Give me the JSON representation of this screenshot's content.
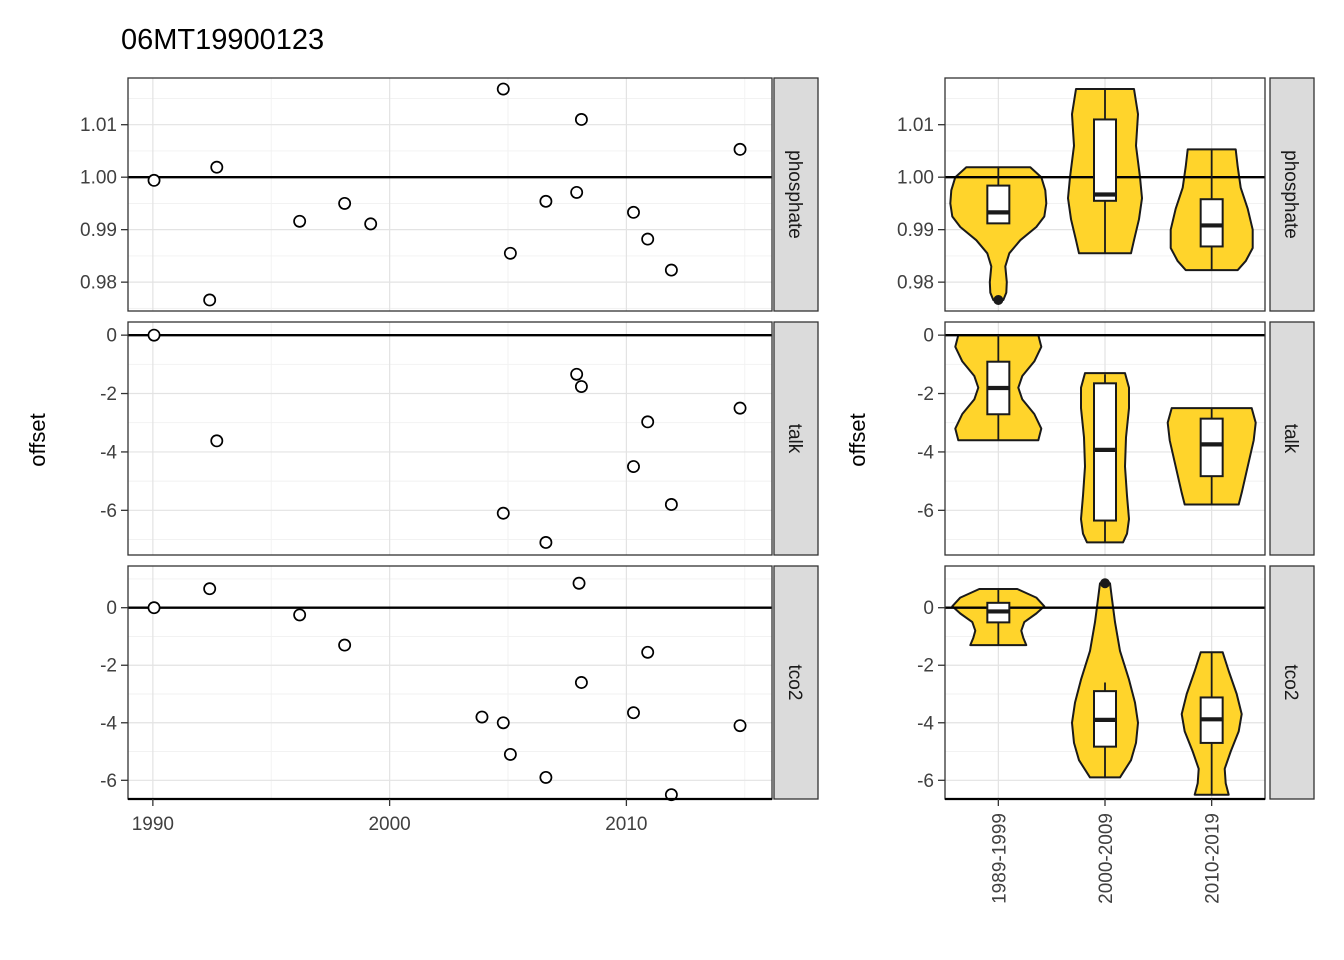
{
  "title": "06MT19900123",
  "ylabel": "offset",
  "colors": {
    "violin_fill": "#FFD42B",
    "outline": "#1A1A1A",
    "panel_border": "#333333",
    "strip_bg": "#DBDBDB",
    "grid_major": "#E3E3E3",
    "grid_minor": "#F1F1F1",
    "axis_text": "#404040",
    "ref_line": "#000000",
    "point_fill": "#FFFFFF"
  },
  "chart_data": {
    "type": [
      "scatter",
      "violin"
    ],
    "title": "06MT19900123",
    "ylabel": "offset",
    "left_plot": {
      "xlabel_ticks": [
        "1990",
        "2000",
        "2010"
      ],
      "xtick_values": [
        1990,
        2000,
        2010
      ],
      "xtick_minor": [
        1995,
        2005,
        2015
      ],
      "xlim": [
        1988.95,
        2016.15
      ],
      "panels": [
        {
          "facet": "phosphate",
          "ref_line": 1.0,
          "ylim": [
            0.9745,
            1.0189
          ],
          "ytick_values": [
            0.98,
            0.99,
            1.0,
            1.01
          ],
          "ytick_labels": [
            "0.98",
            "0.99",
            "1.00",
            "1.01"
          ],
          "ytick_minor": [
            0.975,
            0.985,
            0.995,
            1.005,
            1.015
          ],
          "points": [
            [
              1990.05,
              0.9994
            ],
            [
              1992.4,
              0.9766
            ],
            [
              1992.7,
              1.0019
            ],
            [
              1996.2,
              0.9916
            ],
            [
              1998.1,
              0.995
            ],
            [
              1999.2,
              0.9911
            ],
            [
              2004.8,
              1.0168
            ],
            [
              2005.1,
              0.9855
            ],
            [
              2006.6,
              0.9954
            ],
            [
              2007.9,
              0.9971
            ],
            [
              2008.1,
              1.011
            ],
            [
              2010.3,
              0.9933
            ],
            [
              2010.9,
              0.9882
            ],
            [
              2011.9,
              0.9823
            ],
            [
              2014.8,
              1.0053
            ]
          ]
        },
        {
          "facet": "talk",
          "ref_line": 0,
          "ylim": [
            -7.53,
            0.45
          ],
          "ytick_values": [
            0,
            -2,
            -4,
            -6
          ],
          "ytick_labels": [
            "0",
            "-2",
            "-4",
            "-6"
          ],
          "ytick_minor": [
            -1,
            -3,
            -5,
            -7
          ],
          "points": [
            [
              1990.05,
              0.0
            ],
            [
              1992.7,
              -3.62
            ],
            [
              2004.8,
              -6.1
            ],
            [
              2006.6,
              -7.1
            ],
            [
              2007.9,
              -1.34
            ],
            [
              2008.1,
              -1.76
            ],
            [
              2010.3,
              -4.5
            ],
            [
              2010.9,
              -2.97
            ],
            [
              2011.9,
              -5.8
            ],
            [
              2014.8,
              -2.5
            ]
          ]
        },
        {
          "facet": "tco2",
          "ref_line": 0,
          "ylim": [
            -6.65,
            1.45
          ],
          "ytick_values": [
            0,
            -2,
            -4,
            -6
          ],
          "ytick_labels": [
            "0",
            "-2",
            "-4",
            "-6"
          ],
          "ytick_minor": [
            1,
            -1,
            -3,
            -5
          ],
          "points": [
            [
              1990.05,
              0.0
            ],
            [
              1992.4,
              0.66
            ],
            [
              1996.2,
              -0.25
            ],
            [
              1998.1,
              -1.3
            ],
            [
              2003.9,
              -3.8
            ],
            [
              2004.8,
              -4.0
            ],
            [
              2005.1,
              -5.1
            ],
            [
              2006.6,
              -5.9
            ],
            [
              2008.0,
              0.85
            ],
            [
              2008.1,
              -2.6
            ],
            [
              2010.3,
              -3.65
            ],
            [
              2010.9,
              -1.55
            ],
            [
              2011.9,
              -6.5
            ],
            [
              2014.8,
              -4.1
            ]
          ]
        }
      ]
    },
    "right_plot": {
      "categories": [
        "1989-1999",
        "2000-2009",
        "2010-2019"
      ],
      "panels": [
        {
          "facet": "phosphate",
          "ref_line": 1.0,
          "ylim": [
            0.9745,
            1.0189
          ],
          "ytick_values": [
            0.98,
            0.99,
            1.0,
            1.01
          ],
          "ytick_labels": [
            "0.98",
            "0.99",
            "1.00",
            "1.01"
          ],
          "ytick_minor": [
            0.975,
            0.985,
            0.995,
            1.005,
            1.015
          ],
          "violins": [
            {
              "cat": 0,
              "shape": [
                [
                  1.0019,
                  32
                ],
                [
                  1.0,
                  43
                ],
                [
                  0.9975,
                  47
                ],
                [
                  0.995,
                  48
                ],
                [
                  0.9925,
                  46
                ],
                [
                  0.9905,
                  38
                ],
                [
                  0.988,
                  22
                ],
                [
                  0.9855,
                  11
                ],
                [
                  0.983,
                  7
                ],
                [
                  0.98,
                  8.5
                ],
                [
                  0.978,
                  8
                ],
                [
                  0.9766,
                  5
                ]
              ],
              "box": [
                0.9912,
                0.9984
              ],
              "median": 0.9933,
              "whiskers": [
                0.9911,
                1.0019
              ],
              "outliers": [
                0.9766
              ]
            },
            {
              "cat": 1,
              "shape": [
                [
                  1.0168,
                  29
                ],
                [
                  1.012,
                  33
                ],
                [
                  1.006,
                  31
                ],
                [
                  1.0,
                  35
                ],
                [
                  0.996,
                  37
                ],
                [
                  0.992,
                  34
                ],
                [
                  0.988,
                  29
                ],
                [
                  0.9855,
                  26
                ]
              ],
              "box": [
                0.9955,
                1.011
              ],
              "median": 0.9967,
              "whiskers": [
                0.9855,
                1.0168
              ],
              "outliers": []
            },
            {
              "cat": 2,
              "shape": [
                [
                  1.0053,
                  24
                ],
                [
                  1.002,
                  26
                ],
                [
                  0.998,
                  29
                ],
                [
                  0.994,
                  36
                ],
                [
                  0.99,
                  41
                ],
                [
                  0.9865,
                  41
                ],
                [
                  0.984,
                  34
                ],
                [
                  0.9823,
                  26
                ]
              ],
              "box": [
                0.9868,
                0.9958
              ],
              "median": 0.9908,
              "whiskers": [
                0.9823,
                1.0053
              ],
              "outliers": []
            }
          ]
        },
        {
          "facet": "talk",
          "ref_line": 0,
          "ylim": [
            -7.53,
            0.45
          ],
          "ytick_values": [
            0,
            -2,
            -4,
            -6
          ],
          "ytick_labels": [
            "0",
            "-2",
            "-4",
            "-6"
          ],
          "ytick_minor": [
            -1,
            -3,
            -5,
            -7
          ],
          "violins": [
            {
              "cat": 0,
              "shape": [
                [
                  0,
                  40
                ],
                [
                  -0.4,
                  43
                ],
                [
                  -0.9,
                  36
                ],
                [
                  -1.4,
                  24
                ],
                [
                  -1.8,
                  20
                ],
                [
                  -2.2,
                  24
                ],
                [
                  -2.7,
                  36
                ],
                [
                  -3.2,
                  43
                ],
                [
                  -3.6,
                  40
                ]
              ],
              "box": [
                -2.71,
                -0.91
              ],
              "median": -1.81,
              "whiskers": [
                -3.62,
                0.0
              ],
              "outliers": []
            },
            {
              "cat": 1,
              "shape": [
                [
                  -1.3,
                  20
                ],
                [
                  -1.8,
                  24
                ],
                [
                  -2.5,
                  24
                ],
                [
                  -3.5,
                  21
                ],
                [
                  -4.5,
                  20
                ],
                [
                  -5.5,
                  22
                ],
                [
                  -6.3,
                  24
                ],
                [
                  -6.8,
                  22
                ],
                [
                  -7.1,
                  18
                ]
              ],
              "box": [
                -6.35,
                -1.65
              ],
              "median": -3.93,
              "whiskers": [
                -7.1,
                -1.34
              ],
              "outliers": []
            },
            {
              "cat": 2,
              "shape": [
                [
                  -2.5,
                  40
                ],
                [
                  -3.0,
                  44
                ],
                [
                  -3.6,
                  42
                ],
                [
                  -4.2,
                  38
                ],
                [
                  -4.8,
                  34
                ],
                [
                  -5.4,
                  30
                ],
                [
                  -5.8,
                  27
                ]
              ],
              "box": [
                -4.83,
                -2.86
              ],
              "median": -3.74,
              "whiskers": [
                -5.8,
                -2.5
              ],
              "outliers": []
            }
          ]
        },
        {
          "facet": "tco2",
          "ref_line": 0,
          "ylim": [
            -6.65,
            1.45
          ],
          "ytick_values": [
            0,
            -2,
            -4,
            -6
          ],
          "ytick_labels": [
            "0",
            "-2",
            "-4",
            "-6"
          ],
          "ytick_minor": [
            1,
            -1,
            -3,
            -5
          ],
          "violins": [
            {
              "cat": 0,
              "shape": [
                [
                  0.65,
                  19
                ],
                [
                  0.35,
                  38
                ],
                [
                  0.05,
                  46
                ],
                [
                  -0.2,
                  38
                ],
                [
                  -0.5,
                  26
                ],
                [
                  -0.8,
                  23
                ],
                [
                  -1.05,
                  25
                ],
                [
                  -1.3,
                  28
                ]
              ],
              "box": [
                -0.51,
                0.17
              ],
              "median": -0.13,
              "whiskers": [
                -1.3,
                0.66
              ],
              "outliers": []
            },
            {
              "cat": 1,
              "shape": [
                [
                  0.85,
                  5
                ],
                [
                  0.3,
                  7
                ],
                [
                  -0.5,
                  10
                ],
                [
                  -1.5,
                  15
                ],
                [
                  -2.5,
                  24
                ],
                [
                  -3.3,
                  30
                ],
                [
                  -4.0,
                  33
                ],
                [
                  -4.7,
                  31
                ],
                [
                  -5.3,
                  26
                ],
                [
                  -5.9,
                  15
                ]
              ],
              "box": [
                -4.83,
                -2.9
              ],
              "median": -3.9,
              "whiskers": [
                -5.9,
                -2.6
              ],
              "outliers": [
                0.85
              ]
            },
            {
              "cat": 2,
              "shape": [
                [
                  -1.55,
                  11
                ],
                [
                  -2.2,
                  17
                ],
                [
                  -3.0,
                  25
                ],
                [
                  -3.7,
                  30
                ],
                [
                  -4.3,
                  27
                ],
                [
                  -5.0,
                  19
                ],
                [
                  -5.6,
                  13
                ],
                [
                  -6.1,
                  14
                ],
                [
                  -6.5,
                  17
                ]
              ],
              "box": [
                -4.7,
                -3.12
              ],
              "median": -3.88,
              "whiskers": [
                -6.5,
                -1.55
              ],
              "outliers": []
            }
          ]
        }
      ]
    }
  }
}
